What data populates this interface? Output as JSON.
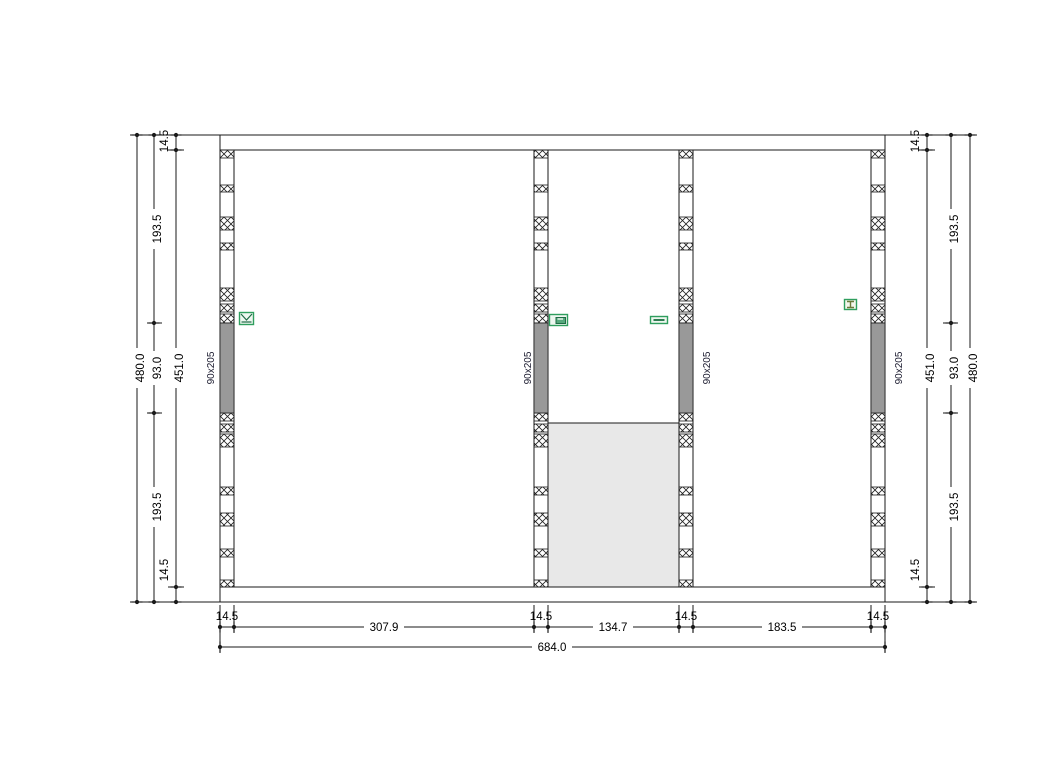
{
  "drawing": {
    "description": "Timber wall framing elevation",
    "studs": [
      {
        "id": 1,
        "size_label": "90x205"
      },
      {
        "id": 2,
        "size_label": "90x205"
      },
      {
        "id": 3,
        "size_label": "90x205"
      },
      {
        "id": 4,
        "size_label": "90x205"
      }
    ],
    "markers": [
      {
        "name": "envelope-marker",
        "near_stud": 1
      },
      {
        "name": "flag-marker",
        "near_stud": 2
      },
      {
        "name": "minus-marker",
        "near_stud": 3
      },
      {
        "name": "ibeam-marker",
        "near_stud": 4
      }
    ]
  },
  "dimensions": {
    "left": {
      "overall": "480.0",
      "inner_height": "451.0",
      "top_plate": "14.5",
      "bottom_plate": "14.5",
      "segments": [
        "193.5",
        "93.0",
        "193.5"
      ]
    },
    "right": {
      "overall": "480.0",
      "inner_height": "451.0",
      "top_plate": "14.5",
      "bottom_plate": "14.5",
      "segments": [
        "193.5",
        "93.0",
        "193.5"
      ]
    },
    "bottom": {
      "overall": "684.0",
      "chain": [
        "14.5",
        "307.9",
        "14.5",
        "134.7",
        "14.5",
        "183.5",
        "14.5"
      ]
    }
  },
  "colors": {
    "line": "#1a1a1a",
    "stud_fill": "#ffffff",
    "solid_block_gray": "#999999",
    "opening_fill": "#e8e8e8",
    "marker_green": "#2f9e5e",
    "marker_glyph": "#1f6b45",
    "stud_label_color": "#1a1a2e"
  }
}
